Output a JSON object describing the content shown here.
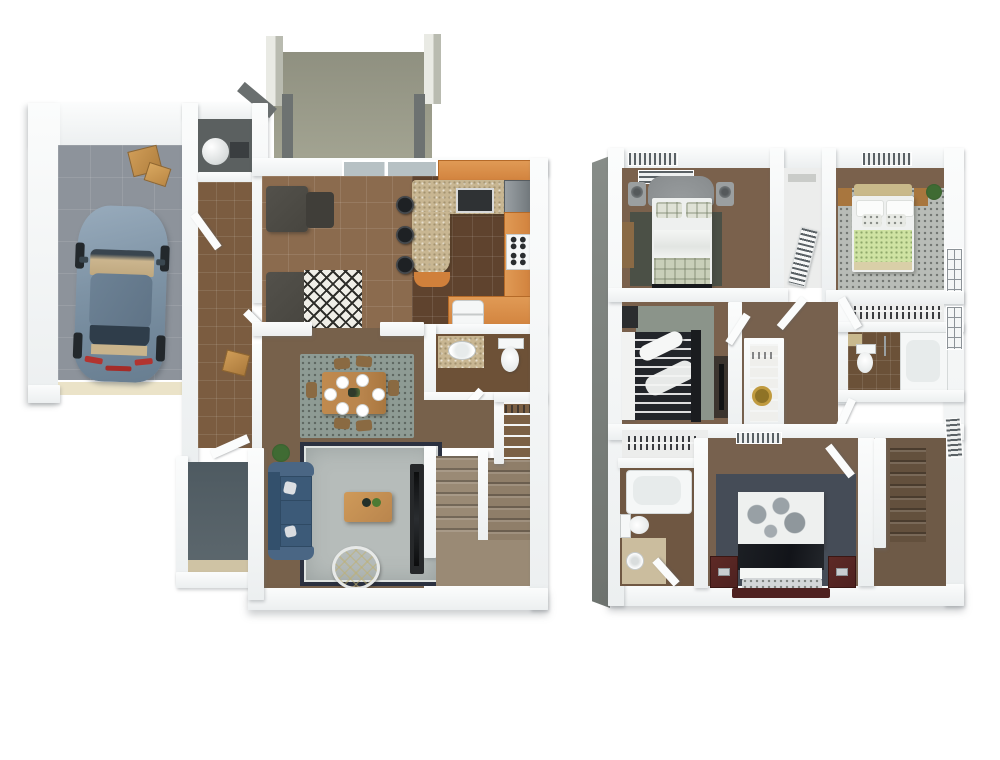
{
  "meta": {
    "description": "3D rendered top-down floor plan of a two-story townhome, no text labels visible",
    "view": "isometric-top-down",
    "background": "#ffffff"
  },
  "palette": {
    "wall": "#fbfcfc",
    "wall_shade": "#eceff0",
    "garage_floor": "#8d939b",
    "tile_entry": "#7b5c40",
    "tile_family": "#8b6b4e",
    "tile_kitchen": "#5f432e",
    "carpet_main": "#77614b",
    "cabinet_orange": "#d0803b",
    "granite": "#c8b692",
    "sofa_dark": "#47453f",
    "couch_navy": "#3c5a78",
    "rug_living": "#b6bcba",
    "rug_border": "#2b3140",
    "rug_dining": "#8e9b94",
    "diamond_rug": "#efeee7",
    "patio_wall": "#9a9b8a",
    "patio_dark": "#6d7271",
    "stairs_up": "#9a8a75",
    "stairs_down": "#63503d",
    "porch_floor": "#5d686e",
    "car_body": "#7e93a5",
    "car_roof": "#5f7386",
    "car_glass": "#2f3d4a",
    "box_tan": "#c2914f",
    "bed_gray_head": "#878b8d",
    "duvet_white": "#eef0ef",
    "plaid_blanket": "#c9cfb9",
    "rug_bed1": "#4b5046",
    "rug_bed2": "#b8bcb7",
    "green_blanket": "#cfe3a3",
    "wood": "#a8763e",
    "wood_light": "#c9b98a",
    "stripe_duvet": "#22252a",
    "rug_bed3": "#8b948a",
    "media_dark": "#3b342e",
    "master_wood": "#4e2120",
    "master_rug": "#454c57",
    "black_blanket": "#121419",
    "white_fixture": "#f5f7f7",
    "vanity_tan": "#c9b98e",
    "closet_floor": "#ecedec",
    "gold": "#c09a3e",
    "plant_green": "#3f6b33",
    "table_wood": "#b9854d",
    "glass": "#b7c1c4",
    "utility_dark": "#5b6060",
    "garage_door": "#ebe3c8",
    "bathmat_tan": "#cbbd9e",
    "bed3_floor_brown": "#6b5138"
  },
  "floors": [
    {
      "id": "first-floor",
      "label": "first-floor",
      "rooms": [
        {
          "id": "garage",
          "label": "garage",
          "items": [
            "car-top-view",
            "moving-boxes",
            "garage-door"
          ]
        },
        {
          "id": "utility-closet",
          "label": "utility-closet",
          "items": [
            "water-heater"
          ]
        },
        {
          "id": "entry-hall",
          "label": "entry-hall",
          "items": [
            "open-door",
            "moving-box"
          ]
        },
        {
          "id": "patio",
          "label": "patio",
          "items": [
            "pillars"
          ]
        },
        {
          "id": "family-room",
          "label": "family-room",
          "items": [
            "sectional-sofa",
            "diamond-rug",
            "window",
            "sliding-glass-door"
          ]
        },
        {
          "id": "kitchen",
          "label": "kitchen",
          "items": [
            "breakfast-bar",
            "bar-stools",
            "range",
            "refrigerator",
            "sink",
            "cabinets"
          ]
        },
        {
          "id": "half-bath",
          "label": "half-bath",
          "items": [
            "vanity-sink",
            "toilet"
          ]
        },
        {
          "id": "pantry-closet",
          "label": "pantry-closet",
          "items": [
            "wire-shelving"
          ]
        },
        {
          "id": "dining-area",
          "label": "dining-area",
          "items": [
            "dining-table",
            "six-chairs",
            "area-rug"
          ]
        },
        {
          "id": "living-room",
          "label": "living-room",
          "items": [
            "navy-sofa",
            "coffee-table",
            "ottoman",
            "tv-console",
            "area-rug",
            "plant"
          ]
        },
        {
          "id": "staircase-up",
          "label": "staircase-up",
          "items": [
            "railing",
            "landing"
          ]
        },
        {
          "id": "porch",
          "label": "porch",
          "items": [
            "front-door"
          ]
        }
      ]
    },
    {
      "id": "second-floor",
      "label": "second-floor",
      "rooms": [
        {
          "id": "bedroom-1",
          "label": "bedroom-1",
          "items": [
            "gray-bed",
            "nightstands",
            "lamps",
            "dresser",
            "rug"
          ]
        },
        {
          "id": "closet-1",
          "label": "closet-1",
          "items": [
            "louvered-door"
          ]
        },
        {
          "id": "bedroom-2",
          "label": "bedroom-2",
          "items": [
            "green-bed",
            "nightstands",
            "plant",
            "speckled-rug"
          ]
        },
        {
          "id": "walk-in-closet",
          "label": "walk-in-closet",
          "items": [
            "hanging-clothes",
            "wire-shelf"
          ]
        },
        {
          "id": "bathroom-2",
          "label": "bathroom-2",
          "items": [
            "tub",
            "toilet",
            "vanity"
          ]
        },
        {
          "id": "bedroom-3",
          "label": "bedroom-3",
          "items": [
            "striped-bed",
            "media-console",
            "speaker",
            "rug"
          ]
        },
        {
          "id": "bedroom-3-closet",
          "label": "bedroom-3-closet",
          "items": [
            "hanging-clothes"
          ]
        },
        {
          "id": "hallway",
          "label": "hallway",
          "items": [
            "linen-closet",
            "gold-decor"
          ]
        },
        {
          "id": "master-bedroom",
          "label": "master-bedroom",
          "items": [
            "cherry-bed",
            "nightstands",
            "slate-rug",
            "vent"
          ]
        },
        {
          "id": "master-bathroom",
          "label": "master-bathroom",
          "items": [
            "tub",
            "toilet",
            "pedestal-sink",
            "bath-mat"
          ]
        },
        {
          "id": "staircase-down",
          "label": "staircase-down",
          "items": [
            "landing",
            "vent"
          ]
        }
      ]
    }
  ]
}
